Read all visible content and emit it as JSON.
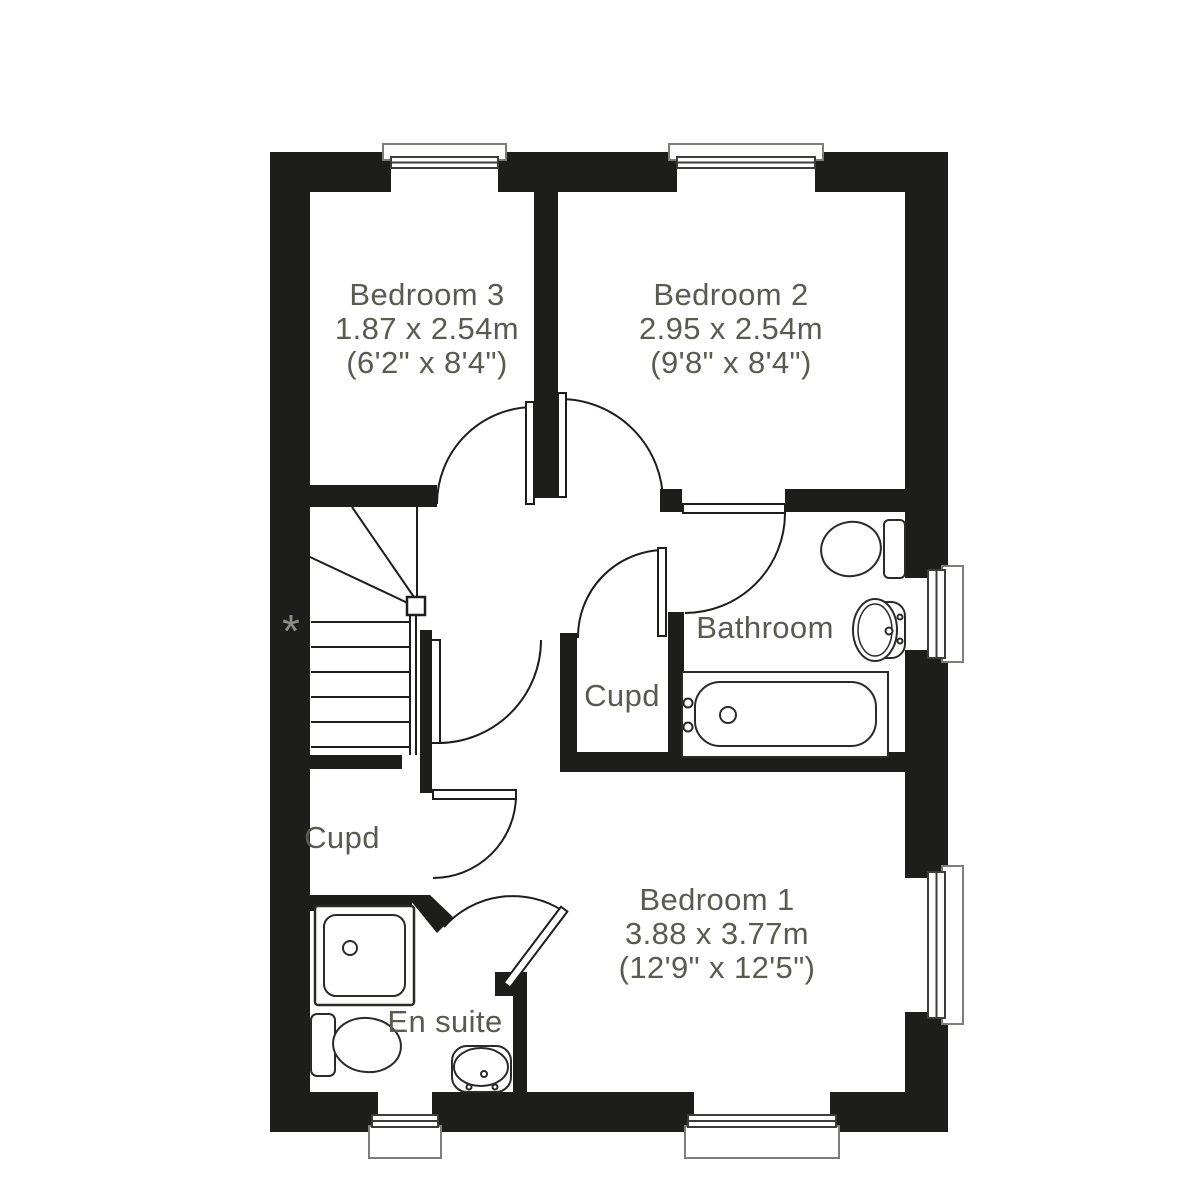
{
  "colors": {
    "background": "#ffffff",
    "wall": "#1d1d1b",
    "line": "#1d1d1b",
    "label_text": "#5a5a52",
    "asterisk": "#8d8d87",
    "window_sill_outline": "#7d7d79"
  },
  "rooms": [
    {
      "id": "bedroom-3",
      "name": "Bedroom 3",
      "size_metric": "1.87 x 2.54m",
      "size_imperial": "(6'2\" x 8'4\")"
    },
    {
      "id": "bedroom-2",
      "name": "Bedroom 2",
      "size_metric": "2.95 x 2.54m",
      "size_imperial": "(9'8\" x 8'4\")"
    },
    {
      "id": "bathroom",
      "name": "Bathroom"
    },
    {
      "id": "cupd-landing",
      "name": "Cupd"
    },
    {
      "id": "cupd-hall",
      "name": "Cupd"
    },
    {
      "id": "en-suite",
      "name": "En suite"
    },
    {
      "id": "bedroom-1",
      "name": "Bedroom 1",
      "size_metric": "3.88 x 3.77m",
      "size_imperial": "(12'9\" x 12'5\")"
    }
  ],
  "annotations": {
    "asterisk": "*"
  },
  "fixture_icons": [
    "stairs-icon",
    "bath-icon",
    "toilet-icon",
    "pedestal-basin-icon",
    "shower-tray-icon",
    "en-suite-toilet-icon",
    "en-suite-basin-icon",
    "window-icon",
    "door-swing-icon"
  ]
}
